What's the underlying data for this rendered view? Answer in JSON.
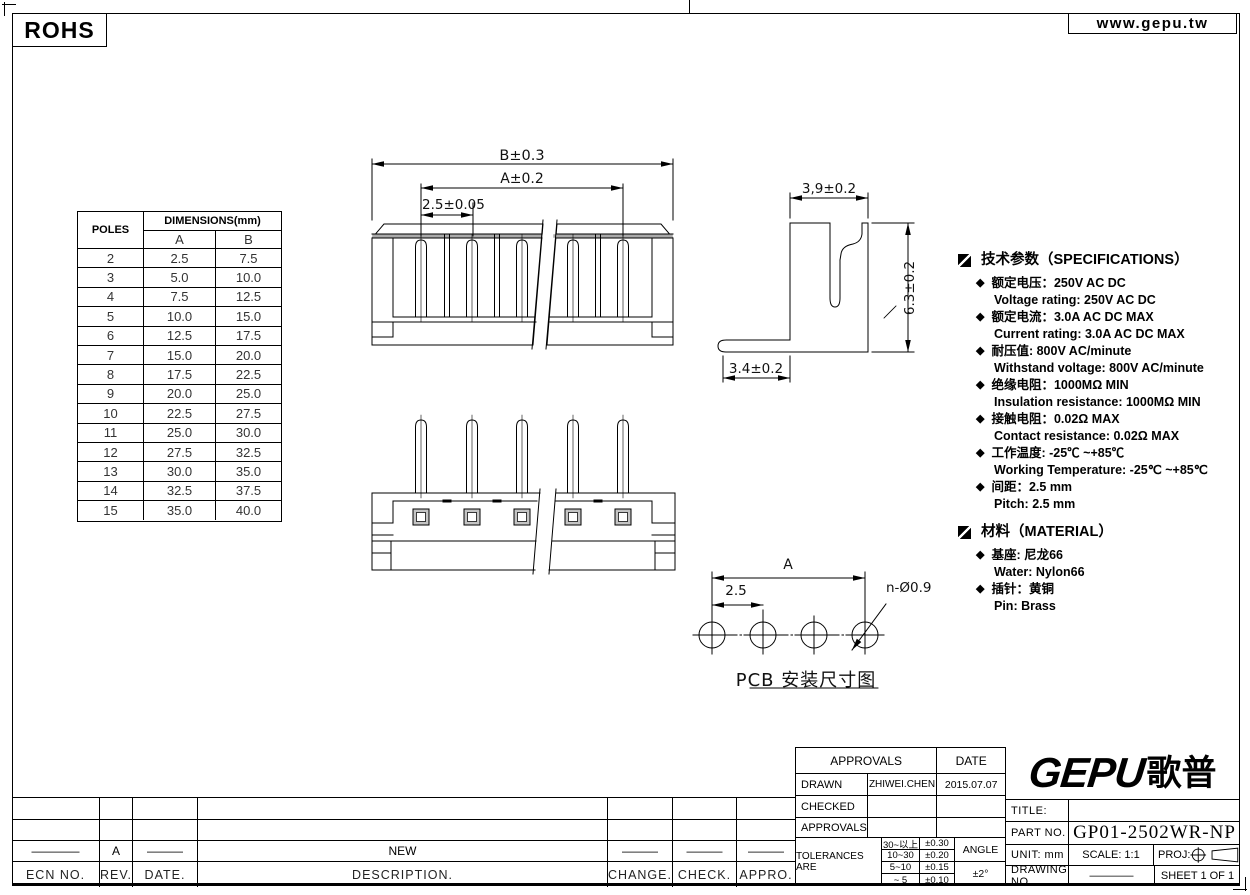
{
  "header": {
    "rohs": "ROHS",
    "website": "www.gepu.tw"
  },
  "dimensions_table": {
    "col_poles": "POLES",
    "col_dimensions": "DIMENSIONS(mm)",
    "col_a": "A",
    "col_b": "B",
    "rows": [
      [
        "2",
        "2.5",
        "7.5"
      ],
      [
        "3",
        "5.0",
        "10.0"
      ],
      [
        "4",
        "7.5",
        "12.5"
      ],
      [
        "5",
        "10.0",
        "15.0"
      ],
      [
        "6",
        "12.5",
        "17.5"
      ],
      [
        "7",
        "15.0",
        "20.0"
      ],
      [
        "8",
        "17.5",
        "22.5"
      ],
      [
        "9",
        "20.0",
        "25.0"
      ],
      [
        "10",
        "22.5",
        "27.5"
      ],
      [
        "11",
        "25.0",
        "30.0"
      ],
      [
        "12",
        "27.5",
        "32.5"
      ],
      [
        "13",
        "30.0",
        "35.0"
      ],
      [
        "14",
        "32.5",
        "37.5"
      ],
      [
        "15",
        "35.0",
        "40.0"
      ]
    ]
  },
  "drawing_labels": {
    "front_width": "B±0.3",
    "front_pin_span": "A±0.2",
    "front_pitch": "2.5±0.05",
    "side_depth": "3,9±0.2",
    "side_height": "6.3±0.2",
    "side_pin_len": "3.4±0.2",
    "pcb_span": "A",
    "pcb_pitch": "2.5",
    "pcb_hole": "n-Ø0.9",
    "pcb_caption": "PCB 安装尺寸图"
  },
  "specifications": {
    "title": "技术参数（SPECIFICATIONS）",
    "bullet": "◆",
    "items": [
      {
        "zh": "额定电压：250V AC DC",
        "en": "Voltage rating: 250V AC DC"
      },
      {
        "zh": "额定电流：3.0A  AC DC   MAX",
        "en": "Current rating: 3.0A  AC DC  MAX"
      },
      {
        "zh": "耐压值: 800V AC/minute",
        "en": "Withstand voltage: 800V AC/minute"
      },
      {
        "zh": "绝缘电阻：1000MΩ  MIN",
        "en": "Insulation resistance: 1000MΩ  MIN"
      },
      {
        "zh": "接触电阻：0.02Ω  MAX",
        "en": "Contact resistance:  0.02Ω  MAX"
      },
      {
        "zh": "工作温度: -25℃ ~+85℃",
        "en": "Working Temperature: -25℃ ~+85℃"
      },
      {
        "zh": "间距：2.5 mm",
        "en": "Pitch: 2.5 mm"
      }
    ]
  },
  "material": {
    "title": "材料（MATERIAL）",
    "items": [
      {
        "zh": "基座: 尼龙66",
        "en": "Water:  Nylon66"
      },
      {
        "zh": "插针：黄铜",
        "en": "Pin: Brass"
      }
    ]
  },
  "revision_table": {
    "headers": [
      "ECN  NO.",
      "REV.",
      "DATE.",
      "DESCRIPTION.",
      "CHANGE.",
      "CHECK.",
      "APPRO."
    ],
    "values": [
      "————",
      "A",
      "———",
      "NEW",
      "———",
      "———",
      "———"
    ]
  },
  "approvals": {
    "approvals_header": "APPROVALS",
    "date_header": "DATE",
    "drawn_label": "DRAWN",
    "drawn_by": "ZHIWEI.CHEN",
    "drawn_date": "2015.07.07",
    "checked_label": "CHECKED",
    "approvals_label": "APPROVALS"
  },
  "tolerances": {
    "label": "TOLERANCES  ARE",
    "rows": [
      [
        "30~以上",
        "±0.30"
      ],
      [
        "10~30",
        "±0.20"
      ],
      [
        "5~10",
        "±0.15"
      ],
      [
        "~ 5",
        "±0.10"
      ]
    ],
    "angle_label": "ANGLE",
    "angle_value": "±2°"
  },
  "title_block": {
    "logo_en": "GEPU",
    "logo_zh": "歌普",
    "title_label": "TITLE:",
    "title_value": "",
    "part_no_label": "PART  NO.",
    "part_no": "GP01-2502WR-NP",
    "unit_label": "UNIT:  mm",
    "scale_label": "SCALE:   1:1",
    "proj_label": "PROJ:",
    "drawing_no_label": "DRAWING  NO.",
    "drawing_no_value": "————",
    "sheet_label": "SHEET   1  OF  1"
  }
}
